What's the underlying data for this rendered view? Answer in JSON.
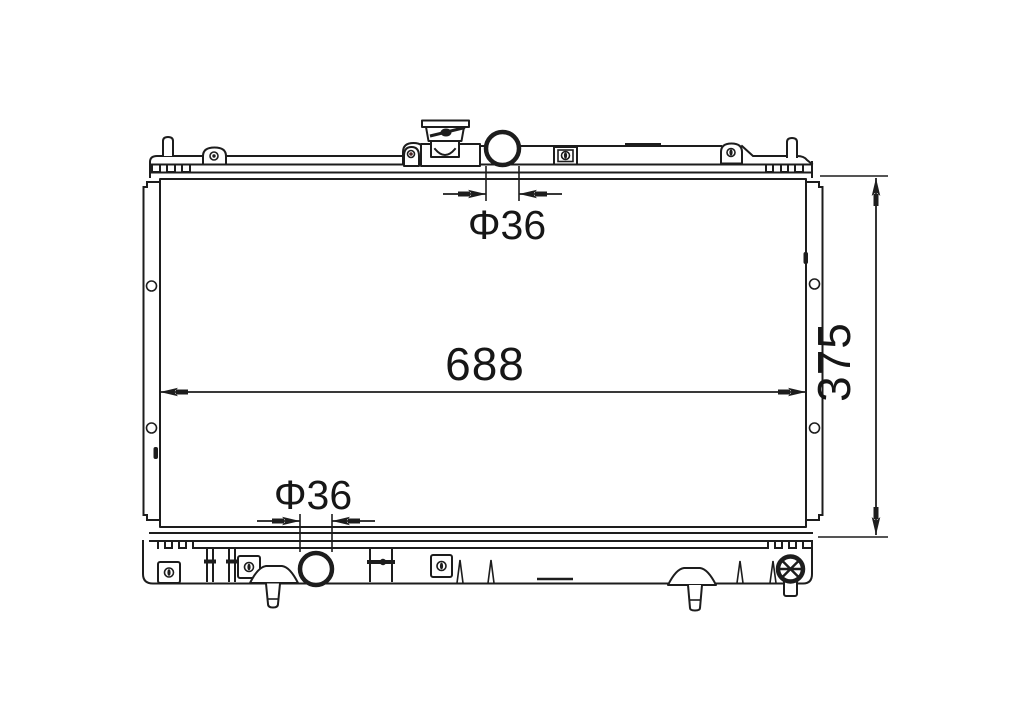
{
  "background_color": "#ffffff",
  "line_color": "#1d1d1d",
  "dimensions": {
    "top_pipe_diameter": "Φ36",
    "core_width": "688",
    "core_height": "375",
    "bottom_pipe_diameter": "Φ36"
  }
}
